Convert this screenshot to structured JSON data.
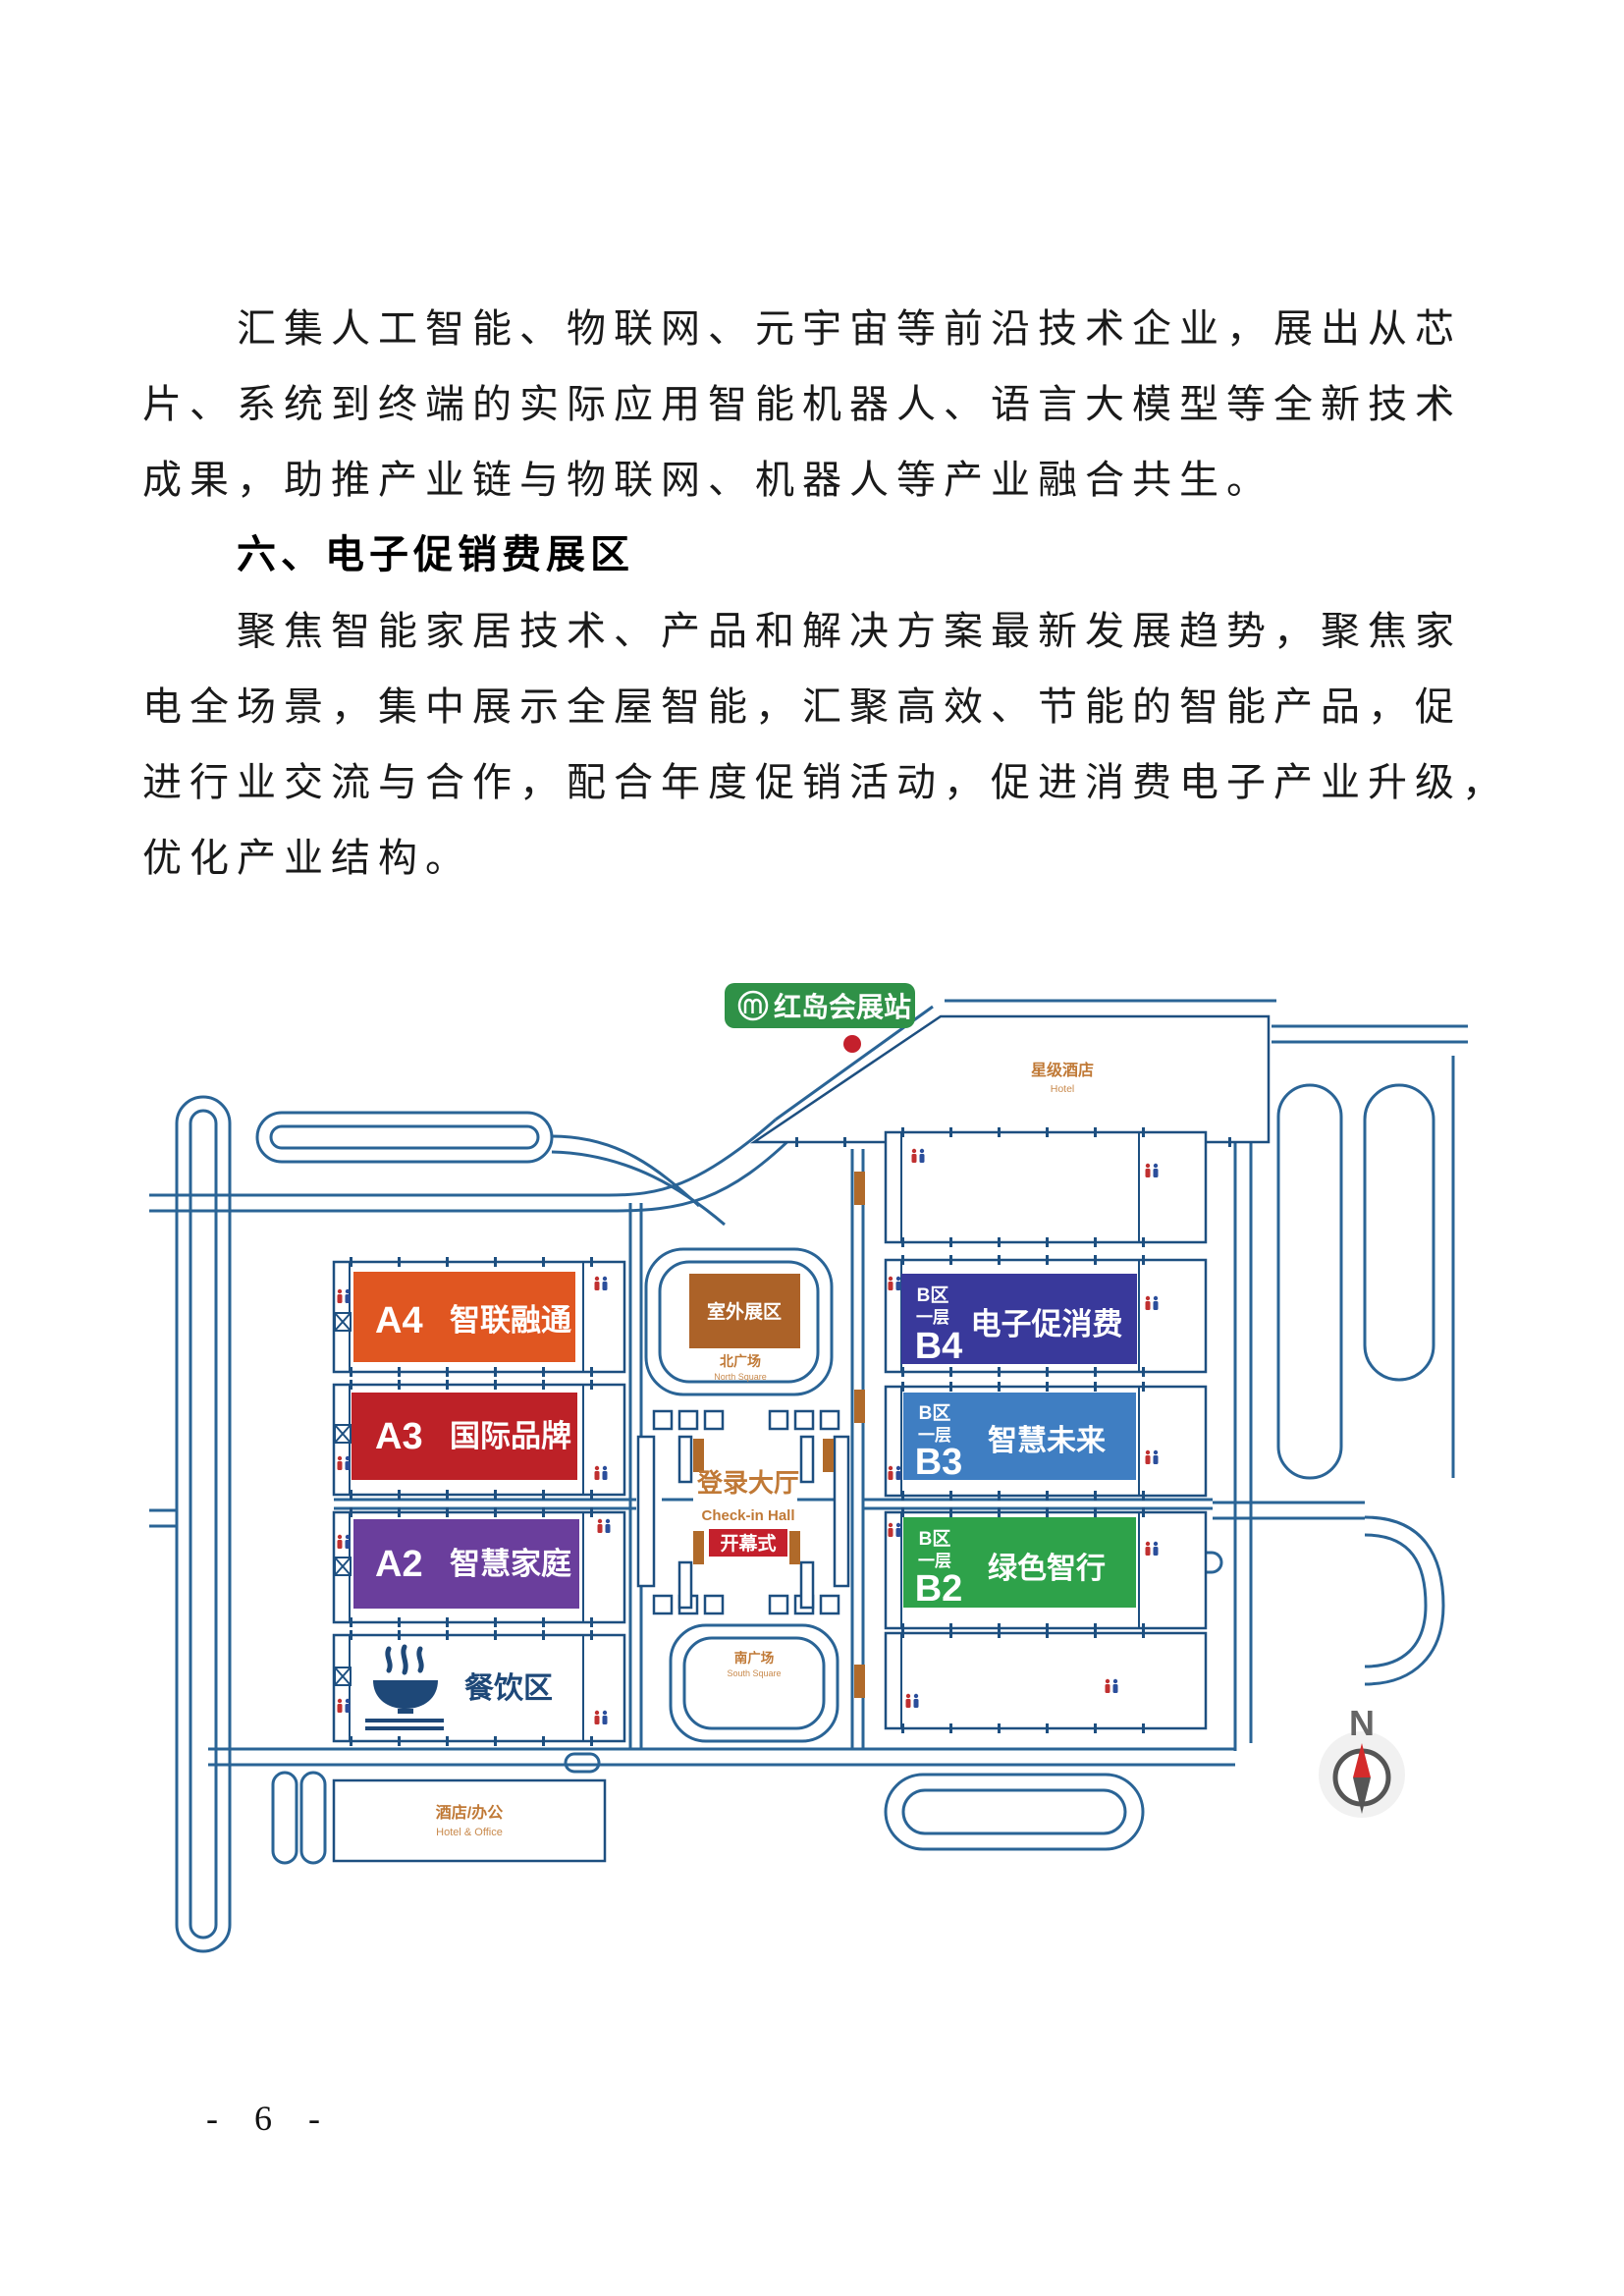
{
  "document": {
    "paragraph1": [
      "汇集人工智能、物联网、元宇宙等前沿技术企业，展出从芯",
      "片、系统到终端的实际应用智能机器人、语言大模型等全新技术",
      "成果，助推产业链与物联网、机器人等产业融合共生。"
    ],
    "heading": "六、电子促销费展区",
    "paragraph2": [
      "聚焦智能家居技术、产品和解决方案最新发展趋势，聚焦家",
      "电全场景，集中展示全屋智能，汇聚高效、节能的智能产品，促",
      "进行业交流与合作，配合年度促销活动，促进消费电子产业升级，",
      "优化产业结构。"
    ],
    "page_number": "- 6 -"
  },
  "map": {
    "station": {
      "label": "红岛会展站",
      "color": "#2F9147"
    },
    "hotel": {
      "zh": "星级酒店",
      "en": "Hotel"
    },
    "halls_a": [
      {
        "id": "A4",
        "name": "智联融通",
        "color": "#E05621"
      },
      {
        "id": "A3",
        "name": "国际品牌",
        "color": "#BD2127"
      },
      {
        "id": "A2",
        "name": "智慧家庭",
        "color": "#6A3E9C"
      }
    ],
    "dining": {
      "label": "餐饮区"
    },
    "outdoor": {
      "label": "室外展区",
      "color": "#AC6228"
    },
    "north_square": {
      "zh": "北广场",
      "en": "North Square"
    },
    "checkin": {
      "zh": "登录大厅",
      "en": "Check-in Hall"
    },
    "opening": {
      "label": "开幕式",
      "color": "#C4202C"
    },
    "south_square": {
      "zh": "南广场",
      "en": "South Square"
    },
    "halls_b": [
      {
        "zone": "B区",
        "floor": "一层",
        "id": "B4",
        "name": "电子促消费",
        "color": "#39399B"
      },
      {
        "zone": "B区",
        "floor": "一层",
        "id": "B3",
        "name": "智慧未来",
        "color": "#3F7EC2"
      },
      {
        "zone": "B区",
        "floor": "一层",
        "id": "B2",
        "name": "绿色智行",
        "color": "#2EA24A"
      }
    ],
    "hotel_office": {
      "zh": "酒店/办公",
      "en": "Hotel & Office"
    },
    "compass": {
      "label": "N"
    },
    "icons": {
      "metro": "metro-logo-icon",
      "restroom": "restroom-icon",
      "stairs": "stairs-box-icon",
      "dining_bowl": "dining-bowl-icon",
      "compass": "compass-icon"
    }
  }
}
